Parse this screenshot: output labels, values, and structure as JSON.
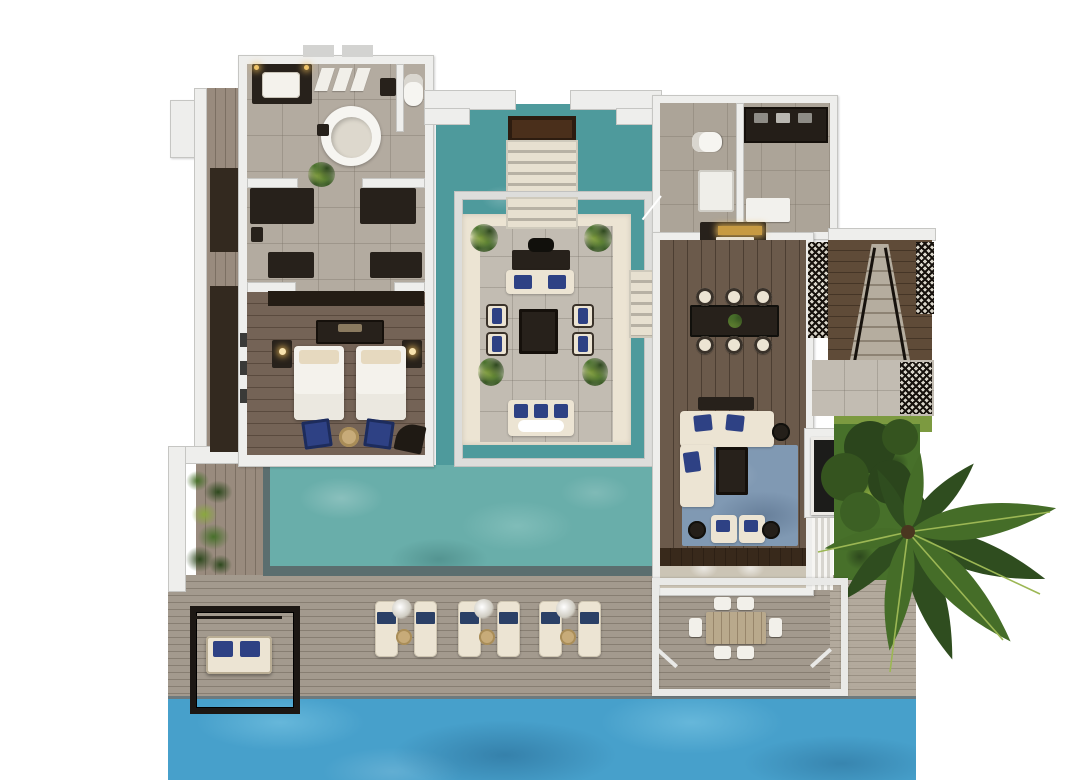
{
  "scene": {
    "description": "Top-down 3D rendered floor plan of a two-wing overwater pool villa with central lounge pavilion, private pool, sun deck and lagoon",
    "view": "top-down axonometric render",
    "visible_text": "none"
  },
  "palette": {
    "wall": "#eeeeec",
    "wallFace": "#c6c6c3",
    "tile": "#b3aba0",
    "woodBed": "#746356",
    "woodDine": "#6b5a4b",
    "woodTerr": "#5f4b38",
    "deck": "#a39a8e",
    "walkway": "#998b7e",
    "deckLight": "#b5ac9f",
    "pond": "#4e9a9c",
    "pool": "#69aeaa",
    "ocean": "#47a0cb",
    "oceanLight": "#66b7da",
    "stone": "#c2bcb2",
    "cream": "#ece4d3",
    "dark": "#27211b",
    "navy": "#2e4184",
    "tan": "#c7ab79",
    "gold": "#c79a42",
    "rug": "#8099b3",
    "grass": "#7c9a40",
    "bushDark": "#2d481d",
    "bushMid": "#47702a",
    "bushLight": "#8aa83f",
    "latticeInk": "#17120d",
    "porch": "#cbc4b5",
    "stepTread": "#e7e0d0",
    "stepGap": "#b7b1a4",
    "poolEdge": "#5b6e6f"
  },
  "rooms": [
    {
      "name": "Master bathroom",
      "features": [
        "double vanity with lit mirror",
        "round freestanding bathtub",
        "toilet",
        "shower",
        "hanging robes",
        "potted plant"
      ]
    },
    {
      "name": "Dressing corridor",
      "features": [
        "dark wardrobe units x4"
      ]
    },
    {
      "name": "Master bedroom",
      "features": [
        "twin beds x2",
        "nightstands with lamps x2",
        "headboard console",
        "navy armchairs x2",
        "round tan ottoman",
        "curved lounge chair"
      ]
    },
    {
      "name": "Entry walkway",
      "features": [
        "timber lintel",
        "stone steps over pond"
      ]
    },
    {
      "name": "Entry pond",
      "features": [
        "reflecting water surrounding pavilion"
      ]
    },
    {
      "name": "Open-air pavilion lounge",
      "features": [
        "writing desk",
        "cushioned bench",
        "cream armchairs x4",
        "square coffee table",
        "daybed",
        "corner plants x4"
      ]
    },
    {
      "name": "Guest WC",
      "features": [
        "toilet",
        "white vanity"
      ]
    },
    {
      "name": "Pantry",
      "features": [
        "dark counter with appliances",
        "white bench"
      ]
    },
    {
      "name": "Bar console",
      "features": [
        "gold-lit counter"
      ]
    },
    {
      "name": "Dining room",
      "features": [
        "dark dining table",
        "cream chairs x6",
        "plant centerpiece"
      ]
    },
    {
      "name": "Living room",
      "features": [
        "L-shaped cream sofa",
        "blue area rug",
        "dark coffee table",
        "side table",
        "cream ottomans x2",
        "dark poufs x2",
        "media console",
        "wall TV",
        "sheer drapes"
      ]
    },
    {
      "name": "Side stair terrace",
      "features": [
        "timber stairs",
        "black lattice railings",
        "stone landing"
      ]
    },
    {
      "name": "Garden",
      "features": [
        "large palm tree",
        "shrub bed",
        "lawn strip"
      ]
    },
    {
      "name": "Main pool",
      "features": [
        "dark tiled edge"
      ]
    },
    {
      "name": "Sun deck",
      "features": [
        "sun loungers x6",
        "round drink tables x3",
        "deck plants x3",
        "black swing-daybed frame",
        "white pergola",
        "outdoor dining table",
        "white outdoor chairs x6"
      ]
    },
    {
      "name": "Lagoon",
      "features": [
        "open sea water"
      ]
    },
    {
      "name": "Arrival jetty",
      "features": [
        "small white landing platform"
      ]
    }
  ],
  "counts": {
    "sun_loungers": 6,
    "outdoor_chairs": 6,
    "indoor_dining_chairs": 6,
    "pavilion_armchairs": 4,
    "beds": 2,
    "palm_trees": 1,
    "water_bodies": 3,
    "wardrobes": 4
  }
}
